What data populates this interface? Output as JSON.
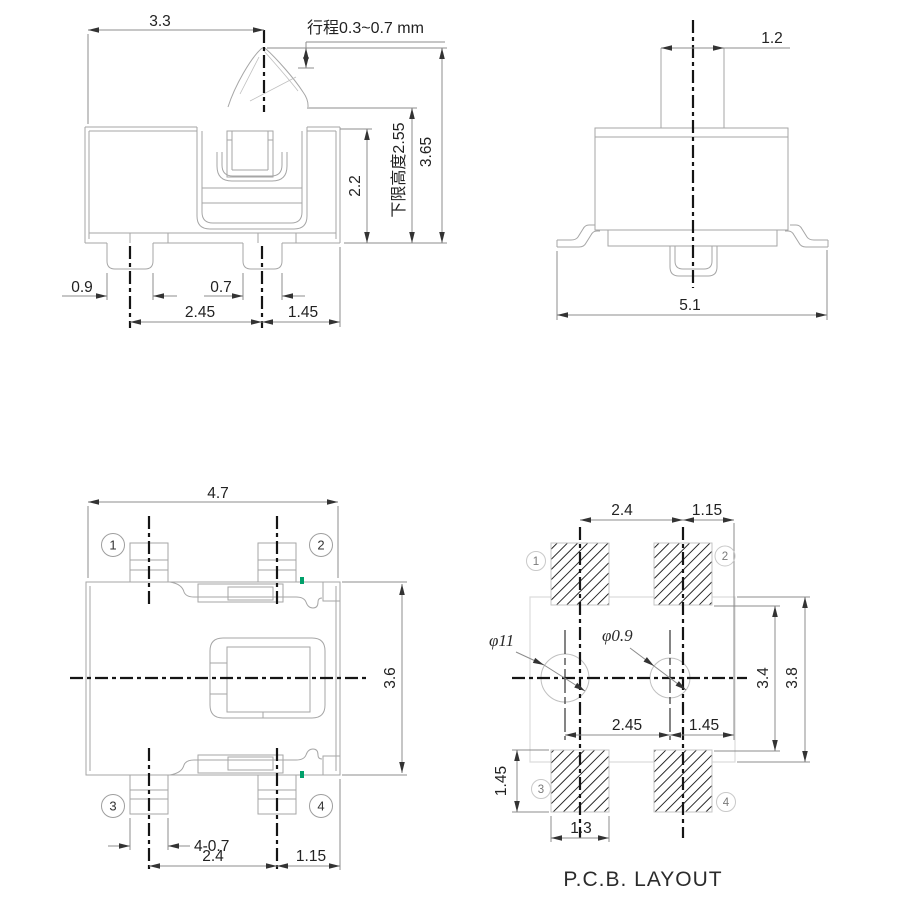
{
  "front_view": {
    "dims": {
      "width_to_stem": "3.3",
      "travel": "行程0.3~0.7 mm",
      "body_height": "2.2",
      "lower_limit_height": "下限高度2.55",
      "total_height": "3.65",
      "leg1_width": "0.9",
      "leg2_width": "0.7",
      "leg_pitch": "2.45",
      "leg_to_edge": "1.45"
    }
  },
  "side_view": {
    "dims": {
      "stem_width": "1.2",
      "total_width": "5.1"
    }
  },
  "top_view": {
    "dims": {
      "total_width": "4.7",
      "total_depth": "3.6",
      "pin_width": "4-0.7",
      "pin_pitch": "2.4",
      "pin_to_edge": "1.15"
    },
    "pins": [
      "1",
      "2",
      "3",
      "4"
    ]
  },
  "pcb_view": {
    "title": "P.C.B. LAYOUT",
    "dims": {
      "pad_pitch": "2.4",
      "pad_to_edge": "1.15",
      "hole1_dia": "φ11",
      "hole2_dia": "φ0.9",
      "inner_span": "3.4",
      "outer_span": "3.8",
      "hole_pitch": "2.45",
      "hole_to_edge": "1.45",
      "pad_height": "1.45",
      "pad_width": "1.3"
    },
    "pads": [
      "1",
      "2",
      "3",
      "4"
    ]
  }
}
